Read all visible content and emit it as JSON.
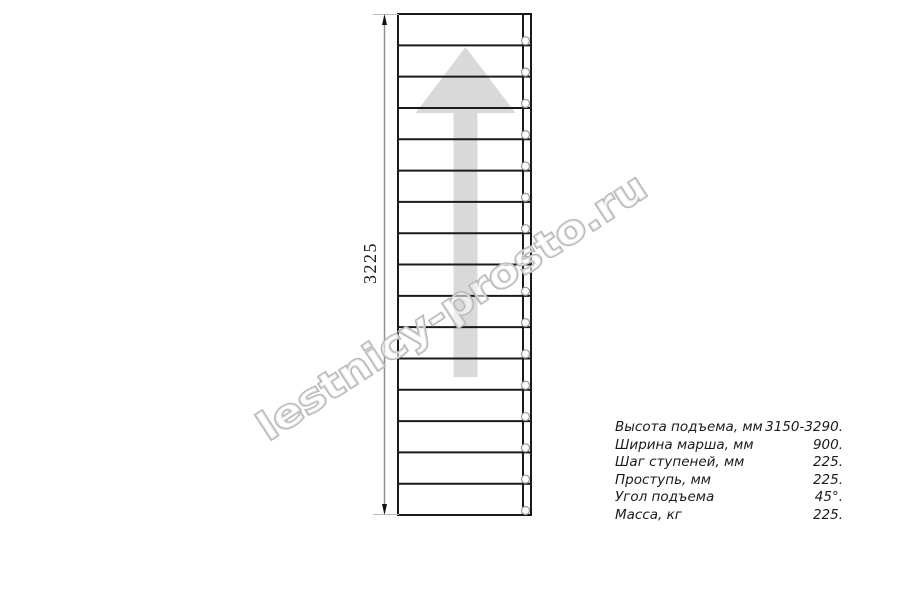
{
  "drawing": {
    "dimension_label": "3225",
    "steps": 16,
    "direction_arrow": "up",
    "colors": {
      "line": "#1a1a1a",
      "dimension_line": "#8f8f8f",
      "extension_line": "#b8b8b8",
      "arrow_fill": "#d9d9d9",
      "circle_stroke": "#9a9a9a",
      "watermark_stroke": "#b3b3b3"
    }
  },
  "watermark": {
    "text": "lestnicy-prosto.ru"
  },
  "spec": {
    "rows": [
      {
        "label": "Высота подъема, мм",
        "value": "3150-3290."
      },
      {
        "label": "Ширина марша, мм",
        "value": "900."
      },
      {
        "label": "Шаг ступеней, мм",
        "value": "225."
      },
      {
        "label": "Проступь, мм",
        "value": "225."
      },
      {
        "label": "Угол подъема",
        "value": "45°."
      },
      {
        "label": "Масса, кг",
        "value": "225."
      }
    ]
  }
}
